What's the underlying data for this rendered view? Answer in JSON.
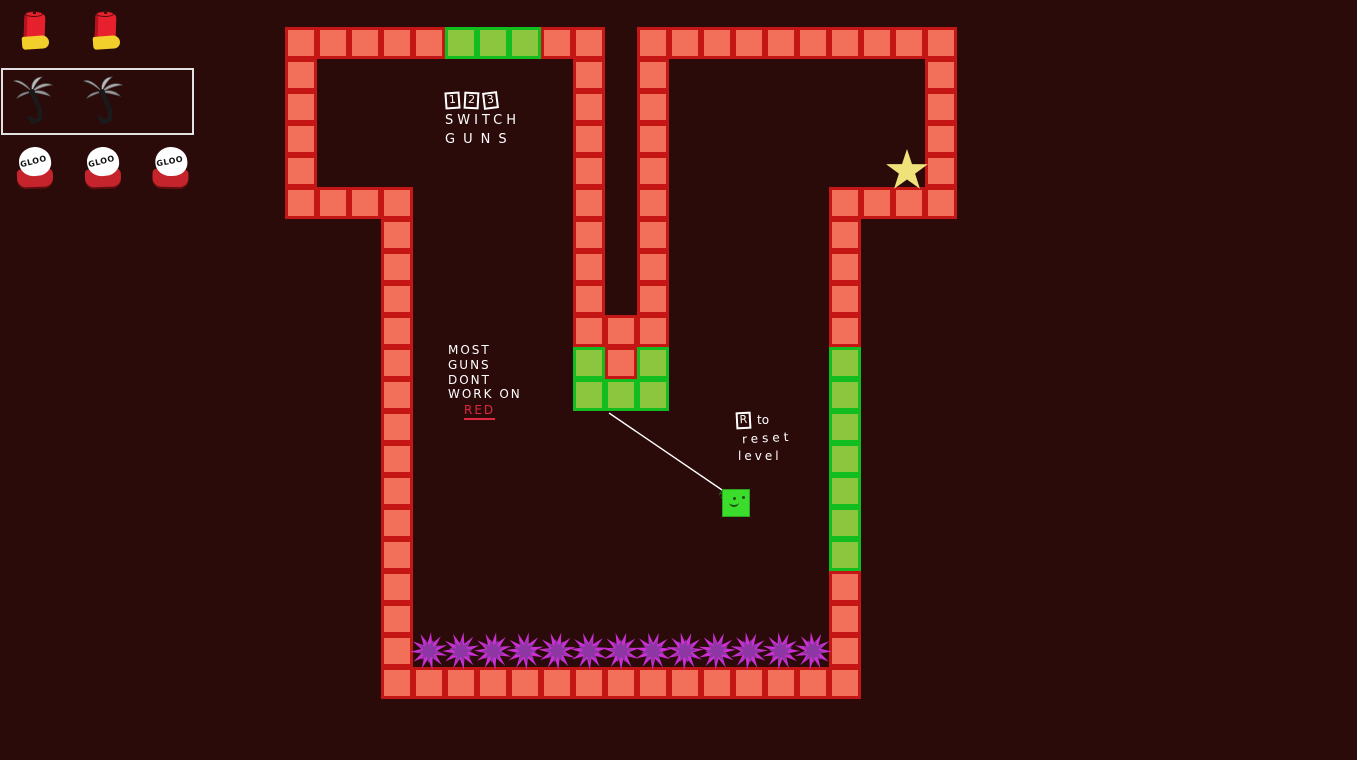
{
  "colors": {
    "background": "#2b0a0a",
    "red_tile_fill": "#f2705a",
    "red_tile_border": "#c51616",
    "green_tile_fill": "#8cc63f",
    "green_tile_border": "#12bd1f",
    "spike_outer": "#c92fd2",
    "spike_inner": "#8e37a4",
    "player_green": "#3cdc2d",
    "star_yellow": "#f0e27b",
    "rope_white": "#ffffff",
    "text_white": "#ffffff",
    "text_red": "#e02840",
    "hud_box_border": "#e2e2e2",
    "shell_red": "#e6202c",
    "shell_brass": "#f2cf2b",
    "hook_grey": "#a8a8a8",
    "gloo_white": "#ffffff",
    "gloo_base_red": "#c6242c"
  },
  "hud": {
    "weapons": [
      {
        "slot": "1",
        "icon": "shotgun-shell-icon",
        "count": 2,
        "selected": false
      },
      {
        "slot": "2",
        "icon": "grapple-hook-icon",
        "count": 2,
        "selected": true
      },
      {
        "slot": "3",
        "icon": "gloo-blob-icon",
        "count": 3,
        "selected": false,
        "label": "GLOO"
      }
    ]
  },
  "instructions": {
    "switch_guns": {
      "keys": [
        "1",
        "2",
        "3"
      ],
      "line1": "SWITCH",
      "line2": "GUNS"
    },
    "most_guns": {
      "line1": "MOST",
      "line2": "GUNS",
      "line3": "DONT",
      "line4": "WORK ON",
      "highlight": "RED"
    },
    "reset": {
      "key": "R",
      "word1": "to",
      "word2": "reset",
      "word3": "level"
    }
  },
  "level": {
    "tile_size": 32,
    "red_runs": [
      {
        "x": 285,
        "y": 27,
        "dir": "h",
        "n": 5
      },
      {
        "x": 541,
        "y": 27,
        "dir": "h",
        "n": 2
      },
      {
        "x": 637,
        "y": 27,
        "dir": "h",
        "n": 10
      },
      {
        "x": 285,
        "y": 59,
        "dir": "v",
        "n": 4
      },
      {
        "x": 285,
        "y": 187,
        "dir": "h",
        "n": 4
      },
      {
        "x": 381,
        "y": 219,
        "dir": "v",
        "n": 14
      },
      {
        "x": 381,
        "y": 667,
        "dir": "h",
        "n": 15
      },
      {
        "x": 573,
        "y": 59,
        "dir": "v",
        "n": 8
      },
      {
        "x": 637,
        "y": 59,
        "dir": "v",
        "n": 8
      },
      {
        "x": 573,
        "y": 315,
        "dir": "h",
        "n": 3
      },
      {
        "x": 605,
        "y": 347,
        "dir": "h",
        "n": 1
      },
      {
        "x": 925,
        "y": 59,
        "dir": "v",
        "n": 4
      },
      {
        "x": 829,
        "y": 187,
        "dir": "h",
        "n": 4
      },
      {
        "x": 829,
        "y": 219,
        "dir": "v",
        "n": 4
      },
      {
        "x": 829,
        "y": 571,
        "dir": "v",
        "n": 3
      }
    ],
    "green_runs": [
      {
        "x": 445,
        "y": 27,
        "dir": "h",
        "n": 3
      },
      {
        "x": 573,
        "y": 347,
        "dir": "h",
        "n": 1
      },
      {
        "x": 637,
        "y": 347,
        "dir": "h",
        "n": 1
      },
      {
        "x": 573,
        "y": 379,
        "dir": "h",
        "n": 3
      },
      {
        "x": 829,
        "y": 347,
        "dir": "v",
        "n": 7
      }
    ],
    "spikes": {
      "x": 413,
      "y_top": 633,
      "count": 13,
      "width": 32
    },
    "star": {
      "cx": 907,
      "cy": 171,
      "outer_r": 22,
      "inner_r": 8.5
    },
    "player": {
      "x": 722,
      "y": 489,
      "size": 28
    },
    "rope": {
      "x1": 609,
      "y1": 413,
      "x2": 725,
      "y2": 492
    }
  }
}
